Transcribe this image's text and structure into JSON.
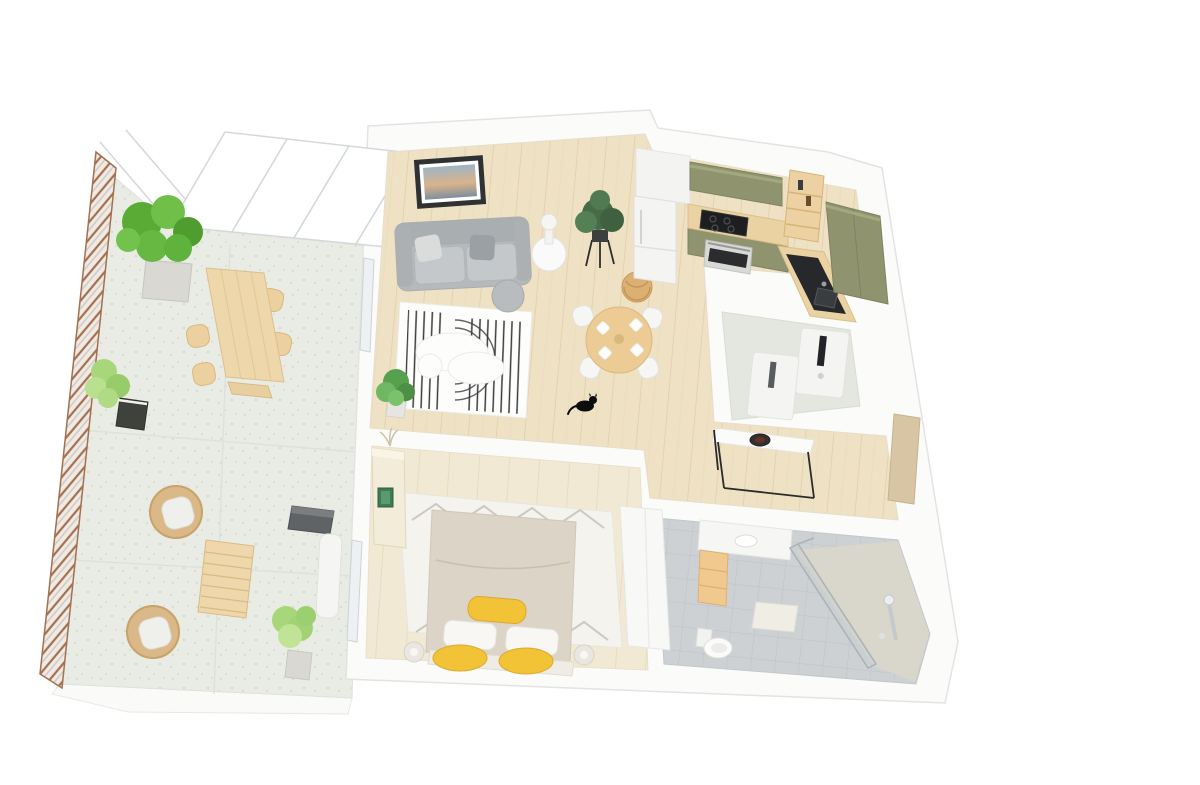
{
  "scene": {
    "type": "3d-floor-plan-render",
    "view": "isometric-top-down-apartment",
    "background": "#ffffff",
    "rooms": [
      {
        "name": "terrace",
        "floor": "speckled-stone",
        "furniture": [
          "tiled-railing-edge",
          "glazed-facade-panels",
          "large-potted-plant",
          "light-potted-plant",
          "outdoor-dining-table",
          "outdoor-chairs-x4",
          "rattan-lounge-chair-x2",
          "slatted-coffee-table",
          "potted-bush",
          "grill",
          "sun-lounger"
        ]
      },
      {
        "name": "living-room",
        "floor": "light-oak-plank",
        "furniture": [
          "gray-sofa",
          "framed-wall-art",
          "round-side-table",
          "table-lamp",
          "plant-on-stand",
          "striped-arc-rug",
          "organic-coffee-table",
          "gray-pouf",
          "corner-plant",
          "black-cat"
        ]
      },
      {
        "name": "dining-area",
        "floor": "light-oak-plank",
        "furniture": [
          "round-wood-dining-table",
          "white-dining-chairs-x4",
          "rattan-pendant-lamp",
          "white-plates-x4"
        ]
      },
      {
        "name": "kitchen",
        "floor": "light-oak-plank",
        "furniture": [
          "white-tall-cabinet",
          "fridge",
          "olive-upper-cabinets",
          "wood-countertop",
          "induction-hob",
          "built-in-oven",
          "ladder-bar-shelf",
          "black-sink-counter",
          "olive-tall-cabinets"
        ]
      },
      {
        "name": "laundry-room",
        "floor": "pale-green-gray",
        "furniture": [
          "washing-machine",
          "dryer-cabinet"
        ]
      },
      {
        "name": "hallway",
        "floor": "light-oak-plank",
        "furniture": [
          "metal-frame-console-table",
          "decor-bowl",
          "open-door-panel"
        ]
      },
      {
        "name": "bedroom",
        "floor": "light-oak-plank",
        "furniture": [
          "double-bed",
          "white-pillows",
          "yellow-bolster",
          "yellow-floor-cushions-x2",
          "diamond-pattern-rug",
          "cream-sideboard",
          "green-artwork",
          "dried-plant",
          "bedside-lamps-x2",
          "white-wardrobe",
          "glazed-terrace-door"
        ]
      },
      {
        "name": "bathroom",
        "floor": "gray-tile",
        "furniture": [
          "vanity-counter",
          "wood-drawer-unit",
          "toilet",
          "glass-shower-screen",
          "shower-column",
          "bath-mat"
        ]
      }
    ]
  },
  "colors": {
    "wall": "#fbfbfa",
    "wall-edge": "#e3e3e1",
    "floor-wood": "#efe1c4",
    "floor-wood-line": "#e3d2ae",
    "floor-bed": "#f2e9d4",
    "floor-bed-line": "#e8dcc0",
    "terrace-floor": "#e9ece4",
    "terrace-speck": "#d9ddd0",
    "laundry-floor": "#e3e7df",
    "tile-floor": "#cdd1d3",
    "tile-line": "#bec2c5",
    "shower-floor": "#dad6ca",
    "railing-brown": "#a4704f",
    "railing-bg": "#efeae4",
    "glass-stroke": "#d4d8da",
    "window-glass": "#eef1f3",
    "sofa": "#b6b9bc",
    "sofa-dark": "#a9aeb1",
    "sofa-light": "#c5c8ca",
    "pillow-light": "#dadbdb",
    "pillow-gray": "#9aa0a3",
    "art-frame": "#2f3133",
    "rug-base": "#fdfdfc",
    "rug-stripe": "#3c3c3e",
    "pouf": "#b9bcbe",
    "table-wood": "#eccb95",
    "chair-white": "#f6f6f5",
    "pendant": "#dcaf72",
    "olive": "#8f946e",
    "olive-light": "#a3a87f",
    "counter-wood": "#ead2a2",
    "black-counter": "#26282b",
    "appliance-white": "#f4f4f3",
    "appliance-slot": "#232426",
    "steel": "#d9dad8",
    "oven-glass": "#2a2c2e",
    "bed-duvet": "#dbd4c7",
    "bed-white": "#f8f7f4",
    "yellow": "#f2c337",
    "yellow-dark": "#dca92b",
    "rug-zigzag": "#ccc9c1",
    "sideboard": "#f3ecd9",
    "green-art": "#3e7b52",
    "wardrobe": "#f8f8f7",
    "drawer-wood": "#f0c98e",
    "toilet-white": "#fbfbfa",
    "glass-fill": "#c3ccd2",
    "door-tan": "#d8c5a3",
    "console-black": "#2b2b2b",
    "bowl-dark": "#33302e",
    "cat": "#0d0d0d",
    "plant-dark": "#476b47",
    "plant-green": "#59ab36",
    "plant-green2": "#6fbf49",
    "plant-light": "#a8d77b",
    "plant-pale": "#c9c4a8",
    "pot-gray": "#d9d8d3",
    "pot-dark": "#3f423c",
    "wicker": "#dab887",
    "wicker-dark": "#c7a269",
    "out-wood": "#eed7ab",
    "out-wood-dark": "#ddbf8d",
    "grill": "#5f6366",
    "slab": "#fafaf9"
  }
}
